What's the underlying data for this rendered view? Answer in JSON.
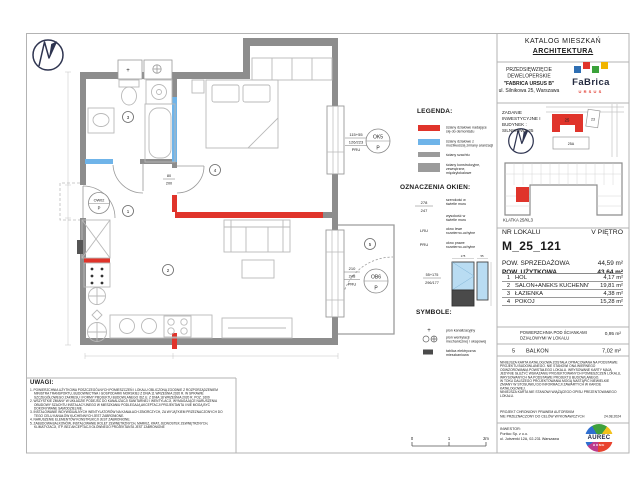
{
  "header": {
    "line1": "KATALOG MIESZKAŃ",
    "line2": "ARCHITEKTURA"
  },
  "development": {
    "l1": "PRZEDSIĘWZIĘCIE",
    "l2": "DEWELOPERSKIE",
    "name": "\"FABRICA URSUS B\"",
    "address": "ul. Silnikowa 25, Warszawa",
    "brand": "FaBrica",
    "brand_sub": "URSUS"
  },
  "task": {
    "l1": "ZADANIE",
    "l2": "INWESTYCYJNE I",
    "l3": "BUDYNEK :",
    "l4": "SILNIKOWA 25",
    "b25": "25",
    "b23": "23",
    "b25a": "25A",
    "klatka": "KLATKA 25/KL3"
  },
  "unit": {
    "nr_label": "NR LOKALU",
    "floor": "V PIĘTRO",
    "number": "M_25_121",
    "pow_sprzedazowa_label": "POW. SPRZEDAŻOWA",
    "pow_sprzedazowa": "44,59 m²",
    "pow_uzytkowa_label": "POW. UŻYTKOWA",
    "pow_uzytkowa": "43,64 m²",
    "rooms": [
      {
        "no": "1",
        "name": "HOL",
        "area": "4,17 m²"
      },
      {
        "no": "2",
        "name": "SALON+ANEKS KUCHENNY",
        "area": "19,81 m²"
      },
      {
        "no": "3",
        "name": "ŁAZIENKA",
        "area": "4,38 m²"
      },
      {
        "no": "4",
        "name": "POKÓJ",
        "area": "15,28 m²"
      }
    ]
  },
  "areas_note": {
    "l1": "POWIERZCHNIA POD ŚCIANKAMI",
    "l2": "DZIAŁOWYMI W LOKALU",
    "value": "0,95 m²"
  },
  "balcony": {
    "no": "5",
    "name": "BALKON",
    "area": "7,02 m²"
  },
  "legend": {
    "title": "LEGENDA:",
    "colors": {
      "demolition": "#e0342b",
      "arrangement": "#6fb4e9",
      "shaft": "#9b9b9b",
      "structural": "#9b9b9b"
    },
    "i1l1": "ściany działowe nadające",
    "i1l2": "się do demontażu",
    "i2l1": "ściany działowe z",
    "i2l2": "możliwością zmiany aranżacji",
    "i3l1": "ściany szachtu",
    "i4l1": "ściany konstrukcyjne,",
    "i4l2": "zewnętrzne,",
    "i4l3": "międzylokalowe"
  },
  "windows_key": {
    "title": "OZNACZENIA OKIEN:",
    "width_num": "278",
    "height_num": "247",
    "width_l1": "szerokość w",
    "width_l2": "świetle muru",
    "height_l1": "wysokość w",
    "height_l2": "świetle muru",
    "left_code": "LRU",
    "left_l1": "okno lewe",
    "left_l2": "rozwierno-uchylne",
    "right_code": "PRU",
    "right_l1": "okno prawe",
    "right_l2": "rozwierno-uchylne",
    "example_top": "55+175",
    "example_bottom": "296/177",
    "dim_door": "175",
    "dim_win": "55"
  },
  "symbols_key": {
    "title": "SYMBOLE:",
    "plus": "+",
    "sewage_label": "pion kanalizacyjny",
    "vent_l1": "pion wentylacji",
    "vent_l2": "mechanicznej / okapowej",
    "board_l1": "tablica elektryczna",
    "board_l2": "mieszkaniowa"
  },
  "plan": {
    "rooms": {
      "r1": "1",
      "r2": "2",
      "r3": "3",
      "r4": "4",
      "r5": "5"
    },
    "window_ok5": {
      "dim1": "115+55",
      "dim2": "126/223",
      "type": "PRU",
      "code": "OK5",
      "side": "P"
    },
    "door_ob6": {
      "dim1": "210",
      "dim2": "248",
      "type": "PRU",
      "code": "OB6",
      "side": "P"
    },
    "entry": {
      "code": "OW02",
      "side": "P"
    },
    "door4": {
      "w": "80",
      "h": "200"
    }
  },
  "scale": {
    "t0": "0",
    "t1": "1",
    "t2": "2m"
  },
  "uwagi": {
    "title": "UWAGI:",
    "lines": [
      "1. POWIERZCHNIA UŻYTKOWA POSZCZEGÓLNYCH POMIESZCZEŃ I LOKALU OBLICZONA ZGODNIE Z ROZPORZĄDZENIEM",
      "MINISTRA TRANSPORTU, BUDOWNICTWA I GOSPODARKI MORSKIEJ Z DNIA 11 WRZEŚNIA 2020 R. W SPRAWIE",
      "SZCZEGÓŁOWEGO ZAKRESU I FORMY PROJEKTU BUDOWLANEGO /DZ.U. Z DNIA 18 WRZEŚNIA 2020 R. POZ. 1609",
      "2. WSZYSTKIE ZMIANY W UKŁADZIE PODEJŚĆ DO KANALIZACJI SANITARNEJ I WENTYLACJI, WYMAGAJĄCE NARUSZENIA",
      "OBUDOWY SZACHTU INSTALACYJNEGO W MIESZKANIU PODLEGAJĄ AKCEPTACJI PROJEKTANTA I NIE MOGĄ BYĆ",
      "DOKONYWANE SAMODZIELNIE.",
      "3. INSTALOWANIE INDYWIDUALNYCH WENTYLATORÓW NA KANAŁACH ZBIORCZYCH, ZA WYJĄTKIEM PRZEZNACZONYCH DO",
      "TEGO CELU KANAŁÓW KUCHENNYCH JEST ZABRONIONE.",
      "4. NARUSZENIE ELEMENTÓW KONSTRUKCJI JEST ZABRONIONE.",
      "5. ZABUDOWA BALKONÓW, INSTALOWANIE ROLET ZEWNĘTRZNYCH, MARKIZ, KRAT, JEDNOSTEK ZEWNĘTRZNYCH,",
      "KLIMATYZACJI, ITP. BEZ AKCEPTACJI GŁÓWNEGO PROJEKTANTA JEST ZABRONIONE"
    ]
  },
  "disclaimer": {
    "lines": [
      "NINIEJSZA KARTA KATALOGOWA ZOSTAŁA OPRACOWANA NA PODSTAWIE",
      "PROJEKTU BUDOWLANEGO. NIE STANOWI ONA WIERNEGO",
      "ODWZOROWANIA POWSTAŁEGO LOKALU. WRYSOWANE KARTY MAJĄ",
      "JEDYNIE SŁUŻYĆ WSKAZANIU PROJEKTOWANYCH POMIESZCZEŃ LOKALU,",
      "WRYSOWANYCH NA PODSTAWIE PROJEKTU BUDOWLANEGO.",
      "W TOKU DALSZEGO PROJEKTOWANIA MOGĄ NASTĄPIĆ NIEWIELKIE",
      "ZMIANY W STOSUNKU DO INFORMACJI ZAWARTYCH W KARCIE",
      "KATALOGOWEJ.",
      "NINIEJSZA KARTA NIE STANOWI WIĄŻĄCEGO OPISU PREZENTOWANEGO",
      "LOKALU."
    ]
  },
  "copyright": {
    "l1": "PROJEKT CHRONIONY PRAWEM AUTORSKIM",
    "l2": "NIE PRZEZNACZONY DO CELÓW WYKONAWCZYCH",
    "date": "24.08.2024"
  },
  "investor": {
    "label": "INWESTOR:",
    "name": "Portico Sp. z o.o.",
    "address": "ul. Jutrzenki 12A, 02-231 Warszawa"
  },
  "aurec": {
    "name": "AUREC",
    "sub": "HOME"
  }
}
